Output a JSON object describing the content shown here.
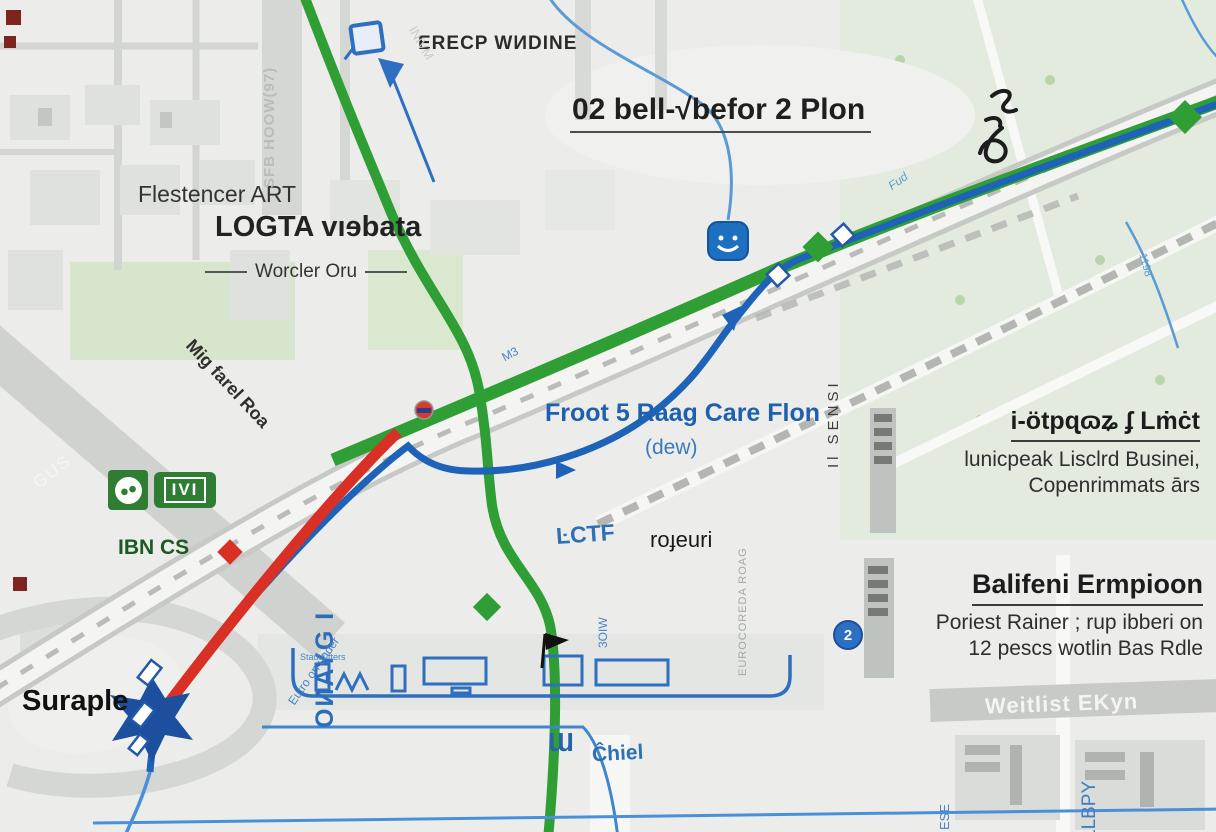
{
  "colors": {
    "route_green": "#2f9e35",
    "route_blue": "#1e63b7",
    "route_red": "#d93025",
    "thin_blue": "#5b9bd5",
    "logo_green": "#2e7d32",
    "accent_blue": "#2a6db8",
    "road_gray": "#d2d5d1",
    "background": "#ecedeb"
  },
  "title": {
    "text": "02 bell-√befor 2 Plon"
  },
  "labels": {
    "erecp": "ERECP WИDINE",
    "flestencer": "Flestencer ART",
    "logta": "LOGTA vıɘbata",
    "worcler": "Worcler Oru",
    "froot": "Froot 5 Raag Care Flon",
    "dew": "(dew)",
    "iotp_title": "i-ötpɋɷʑ ʄ Lṁċt",
    "iotp_sub1": "lunicpeak Lisclrd Businei,",
    "iotp_sub2": "Copenrimmats ārs",
    "balifeni_title": "Balifeni Ermpioon",
    "balifeni_sub1": "Poriest Rainer ; rup ibberi on",
    "balifeni_sub2": "12 pescs wotlin Bas Rdle",
    "suraple": "Suraple",
    "ibn_cs": "IBN CS",
    "logo_ivi": "IVI",
    "ctf": "ĿCTF",
    "rojeuri": "roɟeuri",
    "chiel": "Ĉhiel",
    "wl_glyph": "Ɯ",
    "weitlist": "Weitlist EKyn",
    "omayg": "OИAYG I",
    "llbpy": "LLBPY",
    "ese": "ESE",
    "sfb": "SFB HOOW(97)",
    "mig": "Mig farel Roa",
    "gus": "GUS",
    "m3": "M3",
    "fud": "Fud",
    "n1198": "1198",
    "il_sensi": "Il SENSI",
    "euro_road": "EUROCOREDA ROAG",
    "o3iw": "3OIW",
    "stadt": "Stadtlüfters",
    "eutro": "Eutro on under",
    "inivm": "INIVM",
    "badge2": "2"
  }
}
